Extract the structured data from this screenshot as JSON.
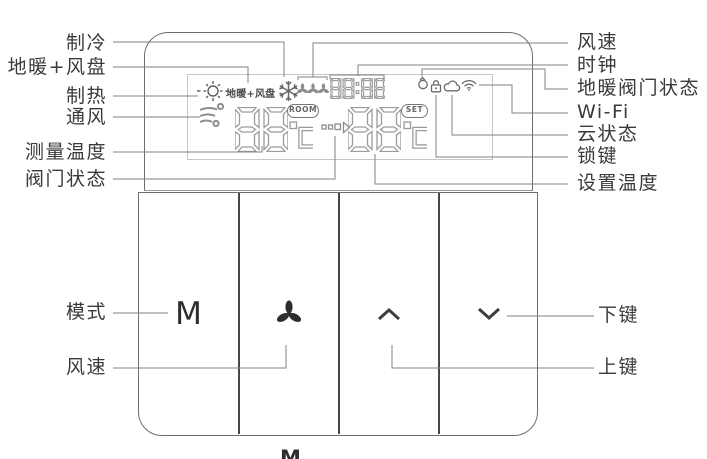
{
  "callouts": {
    "left": {
      "cooling": "制冷",
      "floor_heating_fan_coil": "地暖+风盘",
      "heating": "制热",
      "ventilation": "通风",
      "measured_temperature": "测量温度",
      "valve_status": "阀门状态",
      "mode": "模式",
      "fan_speed": "风速"
    },
    "right": {
      "fan_speed": "风速",
      "clock": "时钟",
      "floor_heating_valve_status": "地暖阀门状态",
      "wifi": "Wi-Fi",
      "cloud_status": "云状态",
      "lock_key": "锁键",
      "set_temperature": "设置温度",
      "down_key": "下键",
      "up_key": "上键"
    }
  },
  "display": {
    "mode_segment_text": "地暖+风盘",
    "room_badge": "ROOM",
    "set_badge": "SET",
    "room_temperature": "88",
    "set_temperature": "88",
    "clock_time": "88:88",
    "temperature_unit": "°C",
    "icons": [
      "sun-heating",
      "snowflake-cooling",
      "fan-speed",
      "clock",
      "floor-valve",
      "lock",
      "cloud",
      "wifi",
      "ventilation",
      "valve-state"
    ]
  },
  "buttons": {
    "mode_label": "M",
    "fan_icon": "fan",
    "up_icon": "chevron-up",
    "down_icon": "chevron-down"
  },
  "footer": {
    "clipped_text": "M"
  },
  "colors": {
    "line": "#828282",
    "label_text": "#3a3a3a",
    "lcd": "#9a9a9a",
    "glyph": "#2d2d2d"
  }
}
